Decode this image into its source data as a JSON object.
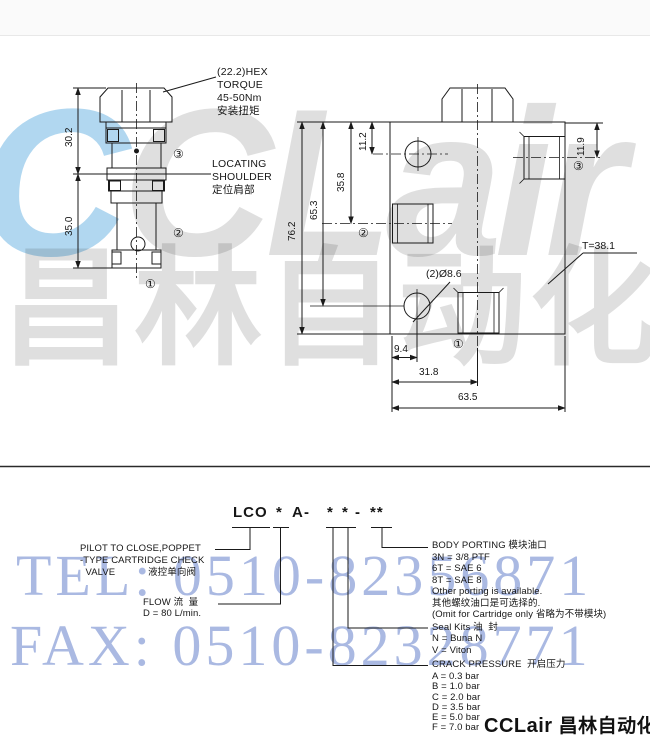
{
  "watermarks": {
    "logo_first": "C",
    "logo_rest": "CLair",
    "logo_cn": "昌林自动化",
    "tel": "TEL: 0510-82356871",
    "fax": "FAX: 0510-82328771"
  },
  "drawing": {
    "hex_note": "(22.2)HEX\nTORQUE\n45-50Nm\n安装扭矩",
    "locating_note": "LOCATING\nSHOULDER\n定位肩部",
    "dims": {
      "v30_2": "30.2",
      "v35_0": "35.0",
      "v76_2": "76.2",
      "v65_3": "65.3",
      "v35_8": "35.8",
      "v11_2": "11.2",
      "v11_9": "11.9",
      "h9_4": "9.4",
      "h31_8": "31.8",
      "h63_5": "63.5",
      "thickness": "T=38.1",
      "hole": "(2)Ø8.6"
    },
    "ports": {
      "p1": "①",
      "p2": "②",
      "p3": "③"
    }
  },
  "ordering": {
    "code_parts": [
      "LCO",
      "*",
      "A",
      "-",
      "*",
      "*",
      "-",
      "**"
    ],
    "pilot": "PILOT TO CLOSE,POPPET\n-TYPE CARTRIDGE CHECK\n  VALVE            液控单向阀",
    "flow": "FLOW 流  量\nD = 80 L/min.",
    "body_porting": "BODY PORTING 模块油口\n3N = 3/8 PTF\n6T = SAE 6\n8T = SAE 8\nOther porting is available.\n其他螺纹油口是可选择的.\n(Omit for Cartridge only 省略为不带模块)",
    "seal": "Seal Kits 油  封\nN = Buna N\nV = Viton",
    "crack_title": "CRACK PRESSURE  开启压力",
    "crack_items": "A = 0.3 bar\nB = 1.0 bar\nC = 2.0 bar\nD = 3.5 bar\nE = 5.0 bar\nF = 7.0 bar"
  },
  "footer_logo": {
    "en": "CCLair",
    "cn": "昌林自动化"
  },
  "colors": {
    "line": "#1a1a1a",
    "watermark_blue": "#aab9e2",
    "logo_blue": "#46a0dc"
  }
}
